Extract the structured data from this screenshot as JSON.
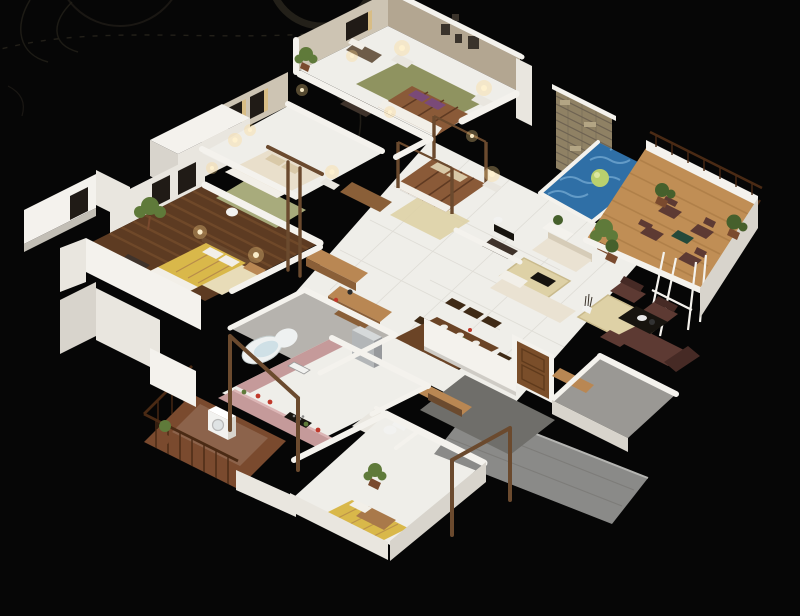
{
  "meta": {
    "description": "Photorealistic isometric 3D floor plan render of a multi-bedroom house on a black background with decorative swirls",
    "view": "isometric-cutaway",
    "canvas": {
      "width": 800,
      "height": 616
    }
  },
  "scene": {
    "rooms": [
      "guest-bedroom",
      "second-bedroom",
      "master-bedroom",
      "third-bedroom",
      "fourth-bedroom",
      "master-bathroom",
      "small-bathroom",
      "kitchen",
      "dining-area",
      "living-area",
      "leather-lounge",
      "entry-hall",
      "swimming-pool",
      "wood-deck",
      "balcony",
      "walkway",
      "porch"
    ],
    "furniture": [
      "double-bed-brown",
      "double-bed-cream",
      "double-bed-yellow",
      "four-poster-bed",
      "single-bed-yellow",
      "cream-sofa-set",
      "leather-sofa-set",
      "coffee-table",
      "dining-table-eight-chairs",
      "kitchen-counters",
      "fridge",
      "jacuzzi-tub",
      "vanity",
      "toilet",
      "washing-machine",
      "deck-chairs",
      "deck-table",
      "nightstands-with-lamps",
      "potted-plants",
      "entry-door",
      "railings",
      "wall-frames"
    ]
  },
  "palette": {
    "background": "#060606",
    "swirl": "#232019",
    "wall_top": "#f4f2ed",
    "wall_light": "#e9e6df",
    "wall_mid": "#d8d4cc",
    "wall_dark": "#c2beb5",
    "marble_wall": "#cdc4b3",
    "accent_taupe": "#b3a691",
    "frame_dark": "#3a332b",
    "window_dark": "#201b16",
    "curtain_gold": "#d8bd85",
    "floor_tile": "#efeee9",
    "floor_grout": "#b9b5ac",
    "wood_floor": "#5d3b22",
    "wood_stripe": "#7d5430",
    "deck_wood": "#c08e55",
    "deck_stripe": "#a3753f",
    "stone_wall": "#8f8164",
    "stone_line": "#6e6352",
    "stone_light": "#b3a584",
    "pool_water": "#2f6fa6",
    "pool_wave": "#7fb2d8",
    "pool_ball": "#b9d06e",
    "pool_ball_light": "#dce8a0",
    "rug_green": "#8f9360",
    "rug_pale": "#a8ab7c",
    "rug_cream": "#e8dcb8",
    "rug_beige": "#ded1a6",
    "bed_brown": "#8a5a38",
    "bed_stripe": "#5f3a22",
    "bed_white": "#f2efe8",
    "pillow_purple": "#7a4a78",
    "bed_cream": "#e9dfcb",
    "pillow_beige": "#d9c9a8",
    "bed_yellow": "#d9b84a",
    "blanket_tan": "#a9794a",
    "sofa_cream": "#eae2d2",
    "sofa_shadow": "#d6ccb8",
    "leather": "#5d3a33",
    "leather_dark": "#462a25",
    "counter_mauve": "#c59a9a",
    "counter_mauve_light": "#dcb6b6",
    "wood_counter": "#b98753",
    "wood_cabinet": "#8a5f38",
    "wood_dark": "#6b4a2e",
    "steel": "#b3b6b8",
    "steel_light": "#d6d9da",
    "steel_dark": "#97999c",
    "door_wood": "#7a4e2a",
    "door_panel": "#5f3a1c",
    "table_wood": "#6b4426",
    "chair_wood": "#3f2a16",
    "gray_path": "#8a8a88",
    "gray_porch": "#9a9894",
    "gray_hall": "#6f6e6a",
    "bath_tile": "#b6b3ae",
    "plant_green": "#5f7a3a",
    "plant_dark": "#46602c",
    "pot_brown": "#7a4a2e",
    "lamp_glow": "#ffd98c",
    "lamp_dot": "#fff2d0",
    "tub_white": "#eef1f1",
    "tub_water": "#cfe0e6",
    "black_furn": "#17140f",
    "white_furn": "#f2f2f0",
    "balcony_floor": "#7a4a2e",
    "railing": "#4a2a14",
    "bench_dark": "#3f332b",
    "chaise_brown": "#6e5c49",
    "deck_table_top": "#23493a",
    "mirror_blue": "#ccd6d8"
  }
}
